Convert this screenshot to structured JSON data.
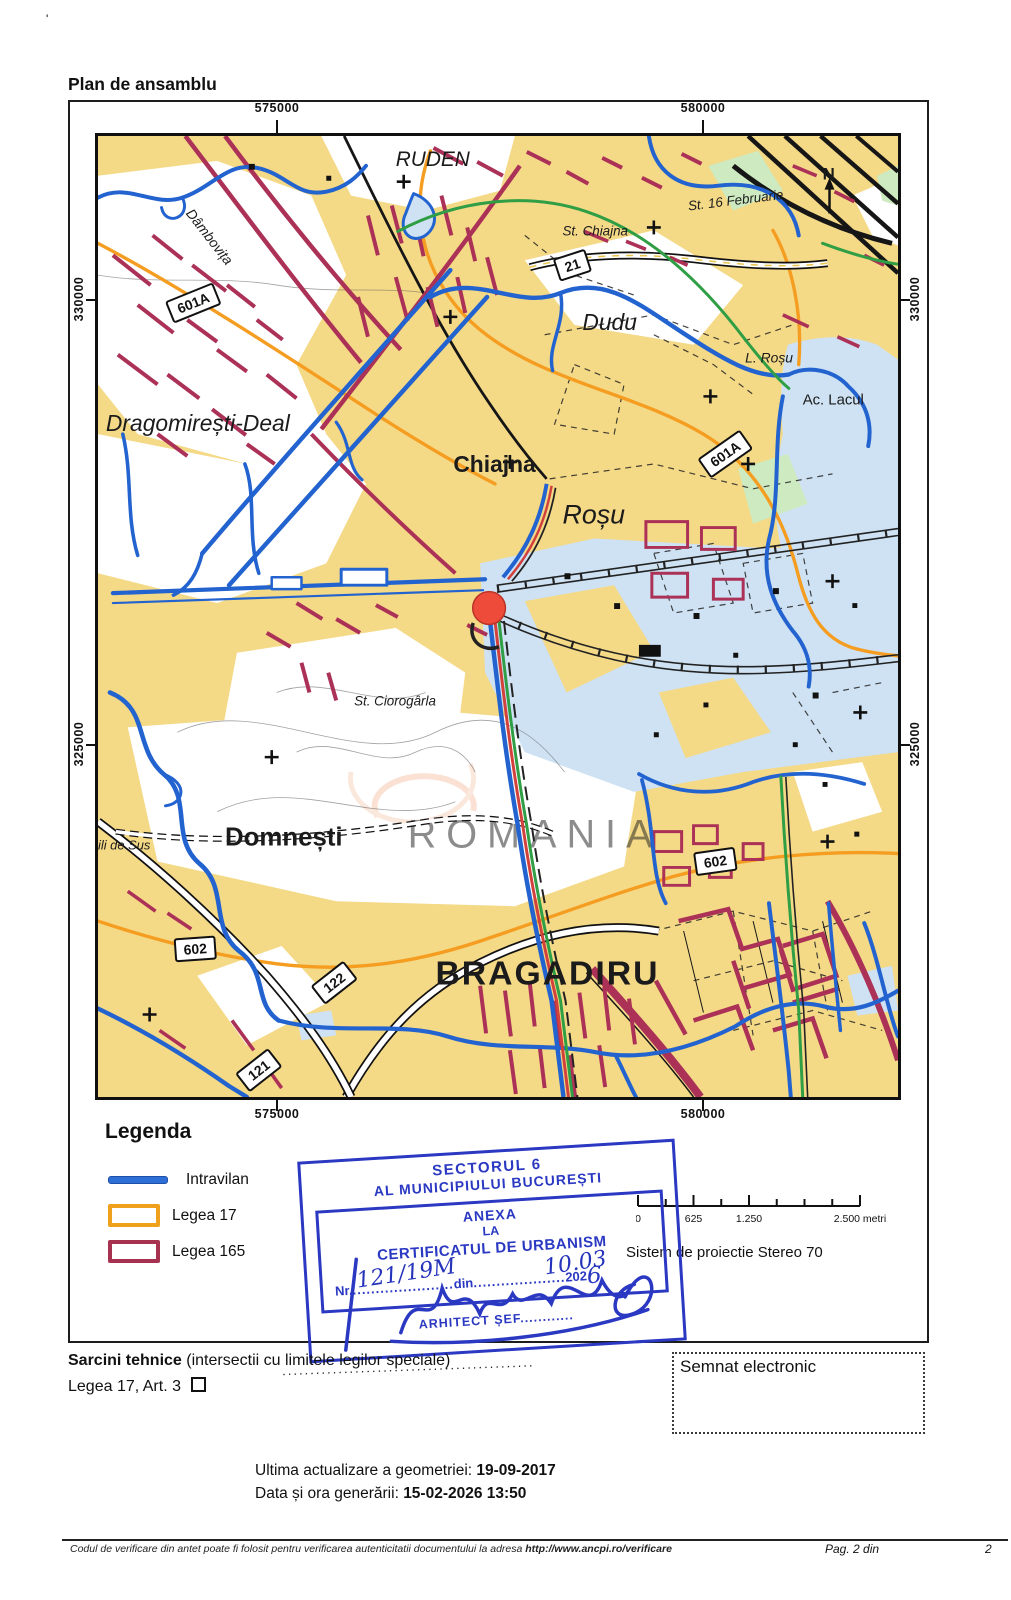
{
  "page": {
    "corner_mark": "'",
    "title": "Plan de ansamblu"
  },
  "frame": {
    "coord_top_left": "575000",
    "coord_top_right": "580000",
    "coord_bottom_left": "575000",
    "coord_bottom_right": "580000",
    "coord_left_top": "330000",
    "coord_left_bottom": "325000",
    "coord_right_top": "330000",
    "coord_right_bottom": "325000"
  },
  "map": {
    "labels": {
      "ruden": "RUDEN",
      "st_16_februarie": "St. 16 Februarie",
      "st_chiajna": "St. Chiajna",
      "dambovita": "Dâmbovița",
      "dudu": "Dudu",
      "l_rosu": "L. Roșu",
      "ac_lacul": "Ac. Lacul",
      "dragomiresti_deal": "Dragomirești-Deal",
      "chiajna": "Chiajna",
      "rosu": "Roșu",
      "st_ciorogarla": "St. Ciorogârla",
      "domnesti": "Domnești",
      "de_sus": "ili de Sus",
      "bragadiru": "BRAGADIRU",
      "compass": "N",
      "watermark": "ROMANIA"
    },
    "road_signs": {
      "sign_21": "21",
      "sign_601a_nw": "601A",
      "sign_601a_e": "601A",
      "sign_602_e": "602",
      "sign_602_w": "602",
      "sign_122": "122",
      "sign_121": "121"
    },
    "marker_color": "#ef4b3a"
  },
  "legend": {
    "title": "Legenda",
    "items": [
      {
        "label": "Intravilan",
        "color": "#2e6fd6",
        "swatch": "line"
      },
      {
        "label": "Legea 17",
        "color": "#efa11c",
        "swatch": "rect"
      },
      {
        "label": "Legea 165",
        "color": "#a63250",
        "swatch": "rect"
      }
    ]
  },
  "scalebar": {
    "tick_0": "0",
    "tick_625": "625",
    "tick_1250": "1.250",
    "tick_2500": "2.500 metri"
  },
  "projection_note": "Sistem de proiectie Stereo 70",
  "stamp": {
    "color": "#2a38c2",
    "header_line1": "SECTORUL 6",
    "header_line2": "AL MUNICIPIULUI BUCUREȘTI",
    "anexa_line1": "ANEXA",
    "anexa_line2": "LA",
    "anexa_line3": "CERTIFICATUL DE URBANISM",
    "nr_prefix": "Nr.",
    "nr_value": "121/19M",
    "dots1": "......................",
    "din_label": "din",
    "dots2": "....................",
    "date_value": "10.03",
    "year_printed": "202",
    "year_digit": "6",
    "arhitect_label": "ARHITECT ȘEF",
    "arhitect_dots": "............"
  },
  "signature_dots": ".............................................",
  "tasks": {
    "sarcini_bold": "Sarcini tehnice",
    "sarcini_rest": " (intersectii cu limitele legilor speciale)",
    "legea_line": "Legea 17, Art. 3"
  },
  "signed_box": {
    "label": "Semnat electronic"
  },
  "generation": {
    "line1_label": "Ultima actualizare a geometriei: ",
    "line1_value": "19-09-2017",
    "line2_label": "Data și ora generării: ",
    "line2_value": "15-02-2026 13:50"
  },
  "footer": {
    "note": "Codul de verificare din antet poate fi folosit pentru verificarea autenticitatii documentului la adresa ",
    "url": "http://www.ancpi.ro/verificare",
    "page_label": "Pag. 2 din",
    "page_total": "2"
  }
}
